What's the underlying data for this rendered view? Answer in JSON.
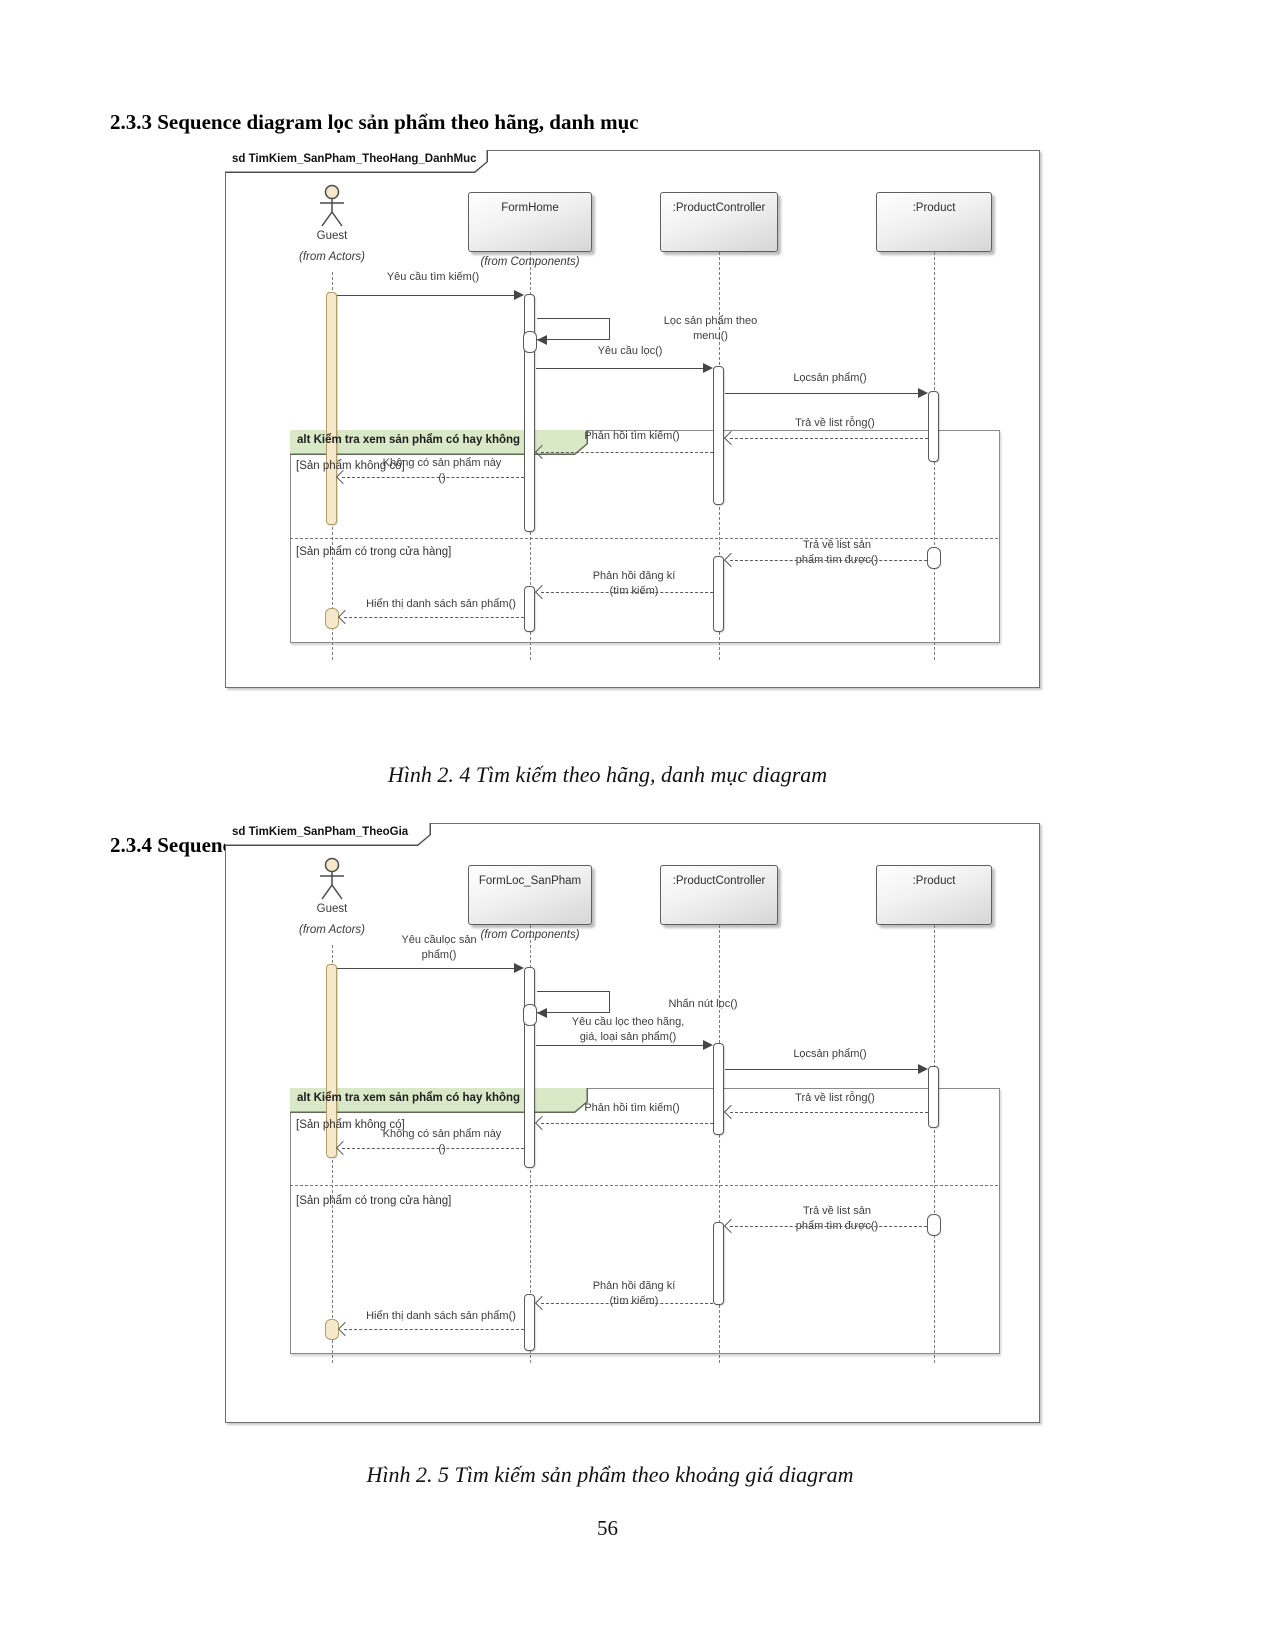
{
  "page": {
    "heading_233": "2.3.3 Sequence diagram lọc sản phẩm theo hãng, danh mục",
    "caption_fig_2_4": "Hình 2. 4 Tìm kiếm theo hãng, danh mục diagram",
    "heading_234": "2.3.4 Sequence diagram lọc sản phẩm theo giá",
    "caption_fig_2_5": "Hình 2. 5 Tìm kiếm sản phẩm theo khoảng giá diagram",
    "page_number": "56"
  },
  "colors": {
    "activation_fill": "#f6e8cb",
    "alt_label_fill": "#d9e8c7",
    "line_gray": "#5a5a5a"
  },
  "d1": {
    "frame_label": "sd TimKiem_SanPham_TheoHang_DanhMuc",
    "actor": {
      "name": "Guest",
      "from": "(from Actors)"
    },
    "form": {
      "name": "FormHome",
      "from": "(from Components)"
    },
    "controller": {
      "name": ":ProductController"
    },
    "product": {
      "name": ":Product"
    },
    "alt": {
      "label": "alt Kiểm tra xem sản phẩm có hay không",
      "guard_not_found": "[Sản phẩm không có]",
      "guard_found": "[Sản phẩm có trong cửa hàng]"
    },
    "msg": {
      "request_search": "Yêu cầu tìm kiếm()",
      "filter_by_menu": "Lọc sản phẩm theo\nmenu()",
      "request_filter": "Yêu cầu lọc()",
      "filter_product": "Lọcsản phẩm()",
      "return_empty": "Trả về list rỗng()",
      "search_reply": "Phản hồi tìm kiếm()",
      "no_product": "Không có sản phẩm này\n()",
      "return_list": "Trả về list sản\nphẩm tìm được()",
      "register_reply": "Phản hồi đăng kí\n(tìm kiếm)",
      "show_list": "Hiển thị danh sách sản phẩm()"
    }
  },
  "d2": {
    "frame_label": "sd TimKiem_SanPham_TheoGia",
    "actor": {
      "name": "Guest",
      "from": "(from Actors)"
    },
    "form": {
      "name": "FormLoc_SanPham",
      "from": "(from Components)"
    },
    "controller": {
      "name": ":ProductController"
    },
    "product": {
      "name": ":Product"
    },
    "alt": {
      "label": "alt Kiểm tra xem sản phẩm có hay không",
      "guard_not_found": "[Sản phẩm không có]",
      "guard_found": "[Sản phẩm có trong cửa hàng]"
    },
    "msg": {
      "request_filter_product": "Yêu cầulọc sản\nphẩm()",
      "click_filter": "Nhấn nút lọc()",
      "request_filter_detail": "Yêu cầu lọc theo hãng,\ngiá, loại sản phẩm()",
      "filter_product": "Lọcsản phẩm()",
      "return_empty": "Trả về list rỗng()",
      "search_reply": "Phản hồi tìm kiếm()",
      "no_product": "Không có sản phẩm này\n()",
      "return_list": "Trả về list sản\nphẩm tìm được()",
      "register_reply": "Phản hồi đăng kí\n(tìm kiếm)",
      "show_list": "Hiển thị danh sách sản phẩm()"
    }
  }
}
